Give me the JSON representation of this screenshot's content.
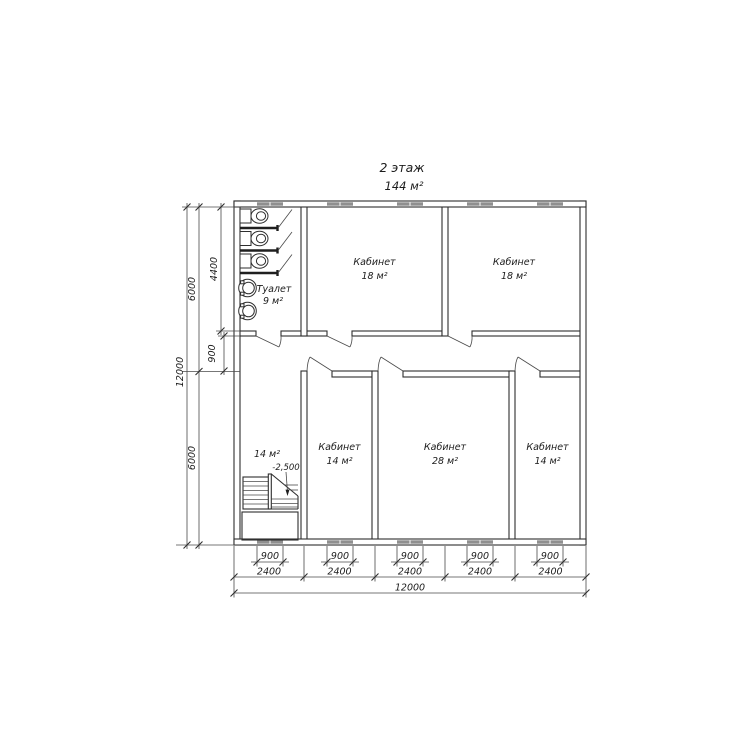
{
  "title": {
    "line1": "2 этаж",
    "line2": "144 м²"
  },
  "rooms": {
    "toilet": {
      "name": "Туалет",
      "area": "9 м²"
    },
    "office_top_left": {
      "name": "Кабинет",
      "area": "18 м²"
    },
    "office_top_right": {
      "name": "Кабинет",
      "area": "18 м²"
    },
    "stairwell": {
      "area": "14 м²",
      "elevation": "-2,500"
    },
    "office_bottom_left": {
      "name": "Кабинет",
      "area": "14 м²"
    },
    "office_bottom_center": {
      "name": "Кабинет",
      "area": "28 м²"
    },
    "office_bottom_right": {
      "name": "Кабинет",
      "area": "14 м²"
    }
  },
  "dimensions": {
    "left": {
      "total_height": "12000",
      "upper_height": "6000",
      "lower_height": "6000",
      "toilet_depth": "4400",
      "corridor_width": "900"
    },
    "bottom": {
      "window_width": "900",
      "bay_width": "2400",
      "total_width": "12000"
    }
  },
  "colors": {
    "line": "#2e2e2e",
    "window_fill": "#8f8f8f",
    "background": "#ffffff"
  }
}
